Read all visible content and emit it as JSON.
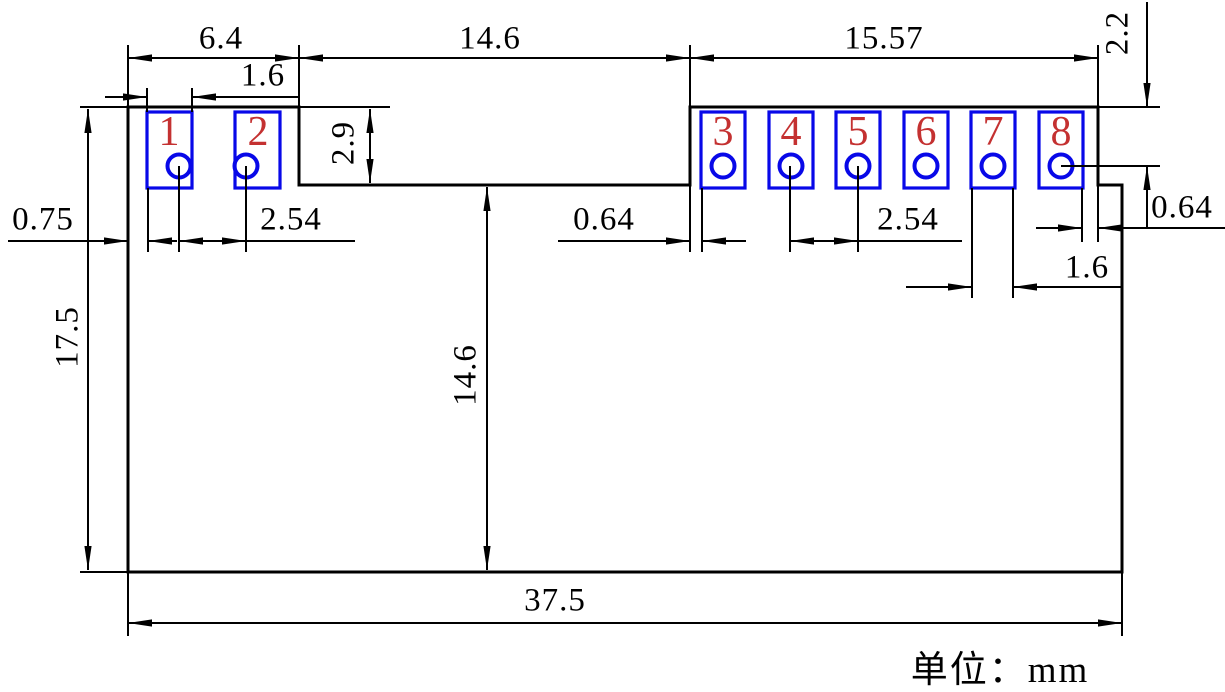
{
  "drawing": {
    "title": "8-pad connector footprint dimension drawing",
    "unit_label": "单位：mm",
    "pads": [
      {
        "label": "1"
      },
      {
        "label": "2"
      },
      {
        "label": "3"
      },
      {
        "label": "4"
      },
      {
        "label": "5"
      },
      {
        "label": "6"
      },
      {
        "label": "7"
      },
      {
        "label": "8"
      }
    ],
    "dims": {
      "left_block_width": "6.4",
      "pad1_width": "1.6",
      "notch_width_top": "14.6",
      "right_block_width": "15.57",
      "hole_center_from_top": "2.2",
      "step_height": "2.9",
      "left_edge_to_pad1": "0.75",
      "left_pitch": "2.54",
      "notch_to_pad3": "0.64",
      "right_pitch": "2.54",
      "pad8_to_right_edge": "0.64",
      "pad7_width": "1.6",
      "body_height": "17.5",
      "notch_depth": "14.6",
      "body_width": "37.5"
    },
    "colors": {
      "outline": "#000000",
      "pad": "#0808e8",
      "pad_number": "#c43131",
      "background": "#ffffff"
    }
  }
}
